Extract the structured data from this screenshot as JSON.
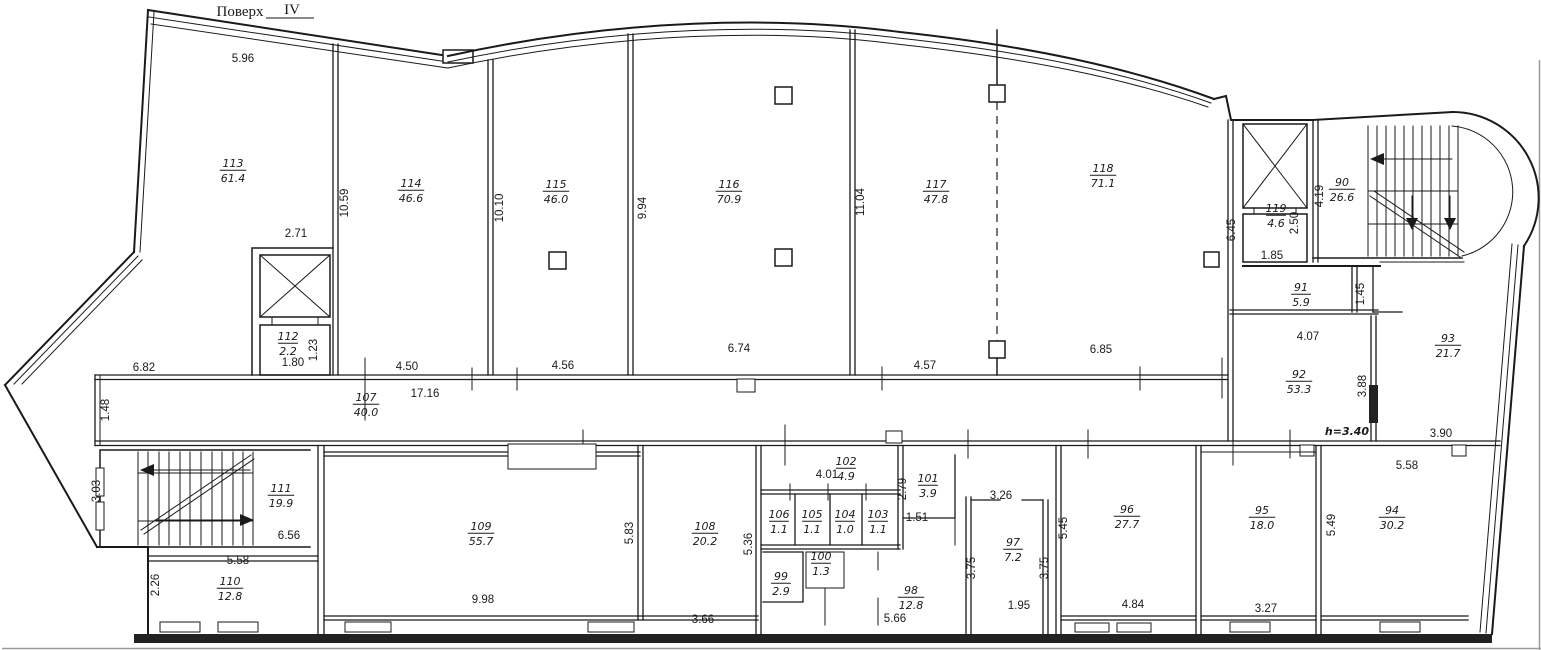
{
  "title": {
    "label": "Поверх",
    "value": "IV"
  },
  "note": {
    "text": "h=3.40",
    "color": "#3c3ccd"
  },
  "plan": {
    "rooms": [
      {
        "n": "113",
        "a": "61.4",
        "x": 233,
        "y": 167
      },
      {
        "n": "114",
        "a": "46.6",
        "x": 411,
        "y": 187
      },
      {
        "n": "115",
        "a": "46.0",
        "x": 556,
        "y": 188
      },
      {
        "n": "116",
        "a": "70.9",
        "x": 729,
        "y": 188
      },
      {
        "n": "117",
        "a": "47.8",
        "x": 936,
        "y": 188
      },
      {
        "n": "118",
        "a": "71.1",
        "x": 1103,
        "y": 172
      },
      {
        "n": "119",
        "a": "4.6",
        "x": 1276,
        "y": 212
      },
      {
        "n": "90",
        "a": "26.6",
        "x": 1342,
        "y": 186
      },
      {
        "n": "91",
        "a": "5.9",
        "x": 1301,
        "y": 291
      },
      {
        "n": "92",
        "a": "53.3",
        "x": 1299,
        "y": 378
      },
      {
        "n": "93",
        "a": "21.7",
        "x": 1448,
        "y": 342
      },
      {
        "n": "112",
        "a": "2.2",
        "x": 288,
        "y": 340
      },
      {
        "n": "107",
        "a": "40.0",
        "x": 366,
        "y": 401
      },
      {
        "n": "111",
        "a": "19.9",
        "x": 281,
        "y": 492
      },
      {
        "n": "110",
        "a": "12.8",
        "x": 230,
        "y": 585
      },
      {
        "n": "109",
        "a": "55.7",
        "x": 481,
        "y": 530
      },
      {
        "n": "108",
        "a": "20.2",
        "x": 705,
        "y": 530
      },
      {
        "n": "106",
        "a": "1.1",
        "x": 779,
        "y": 518
      },
      {
        "n": "105",
        "a": "1.1",
        "x": 812,
        "y": 518
      },
      {
        "n": "104",
        "a": "1.0",
        "x": 845,
        "y": 518
      },
      {
        "n": "103",
        "a": "1.1",
        "x": 878,
        "y": 518
      },
      {
        "n": "102",
        "a": "4.9",
        "x": 846,
        "y": 465
      },
      {
        "n": "101",
        "a": "3.9",
        "x": 928,
        "y": 482
      },
      {
        "n": "100",
        "a": "1.3",
        "x": 821,
        "y": 560
      },
      {
        "n": "99",
        "a": "2.9",
        "x": 781,
        "y": 580
      },
      {
        "n": "98",
        "a": "12.8",
        "x": 911,
        "y": 594
      },
      {
        "n": "97",
        "a": "7.2",
        "x": 1013,
        "y": 546
      },
      {
        "n": "96",
        "a": "27.7",
        "x": 1127,
        "y": 513
      },
      {
        "n": "95",
        "a": "18.0",
        "x": 1262,
        "y": 514
      },
      {
        "n": "94",
        "a": "30.2",
        "x": 1392,
        "y": 514
      }
    ],
    "dims": [
      {
        "t": "5.96",
        "x": 243,
        "y": 62
      },
      {
        "t": "2.71",
        "x": 296,
        "y": 237
      },
      {
        "t": "10.59",
        "x": 348,
        "y": 203,
        "r": 1
      },
      {
        "t": "4.50",
        "x": 407,
        "y": 370
      },
      {
        "t": "17.16",
        "x": 425,
        "y": 397
      },
      {
        "t": "6.82",
        "x": 144,
        "y": 371
      },
      {
        "t": "1.48",
        "x": 109,
        "y": 410,
        "r": 1
      },
      {
        "t": "10.10",
        "x": 503,
        "y": 208,
        "r": 1
      },
      {
        "t": "4.56",
        "x": 563,
        "y": 369
      },
      {
        "t": "9.94",
        "x": 646,
        "y": 208,
        "r": 1
      },
      {
        "t": "6.74",
        "x": 739,
        "y": 352
      },
      {
        "t": "4.57",
        "x": 925,
        "y": 369
      },
      {
        "t": "11.04",
        "x": 864,
        "y": 202,
        "r": 1
      },
      {
        "t": "6.85",
        "x": 1101,
        "y": 353
      },
      {
        "t": "6.45",
        "x": 1235,
        "y": 230,
        "r": 1
      },
      {
        "t": "1.85",
        "x": 1272,
        "y": 259
      },
      {
        "t": "2.50",
        "x": 1298,
        "y": 223,
        "r": 1
      },
      {
        "t": "4.19",
        "x": 1323,
        "y": 196,
        "r": 1
      },
      {
        "t": "1.45",
        "x": 1364,
        "y": 294,
        "r": 1
      },
      {
        "t": "4.07",
        "x": 1308,
        "y": 340
      },
      {
        "t": "3.88",
        "x": 1366,
        "y": 386,
        "r": 1
      },
      {
        "t": "3.90",
        "x": 1441,
        "y": 437
      },
      {
        "t": "5.58",
        "x": 1407,
        "y": 469
      },
      {
        "t": "5.49",
        "x": 1335,
        "y": 525,
        "r": 1
      },
      {
        "t": "3.27",
        "x": 1266,
        "y": 612
      },
      {
        "t": "4.84",
        "x": 1133,
        "y": 608
      },
      {
        "t": "5.45",
        "x": 1067,
        "y": 528,
        "r": 1
      },
      {
        "t": "3.26",
        "x": 1001,
        "y": 499
      },
      {
        "t": "1.95",
        "x": 1019,
        "y": 609
      },
      {
        "t": "3.75",
        "x": 975,
        "y": 568,
        "r": 1
      },
      {
        "t": "3.75",
        "x": 1048,
        "y": 568,
        "r": 1
      },
      {
        "t": "5.66",
        "x": 895,
        "y": 622
      },
      {
        "t": "1.51",
        "x": 917,
        "y": 521
      },
      {
        "t": "2.79",
        "x": 906,
        "y": 489,
        "r": 1
      },
      {
        "t": "4.01",
        "x": 827,
        "y": 478
      },
      {
        "t": "3.66",
        "x": 703,
        "y": 623
      },
      {
        "t": "5.36",
        "x": 752,
        "y": 544,
        "r": 1
      },
      {
        "t": "5.83",
        "x": 633,
        "y": 533,
        "r": 1
      },
      {
        "t": "9.98",
        "x": 483,
        "y": 603
      },
      {
        "t": "3.03",
        "x": 100,
        "y": 491,
        "r": 1
      },
      {
        "t": "6.56",
        "x": 289,
        "y": 539
      },
      {
        "t": "5.58",
        "x": 238,
        "y": 564
      },
      {
        "t": "2.26",
        "x": 159,
        "y": 585,
        "r": 1
      },
      {
        "t": "1.80",
        "x": 293,
        "y": 366
      },
      {
        "t": "1.23",
        "x": 317,
        "y": 350,
        "r": 1
      }
    ]
  }
}
